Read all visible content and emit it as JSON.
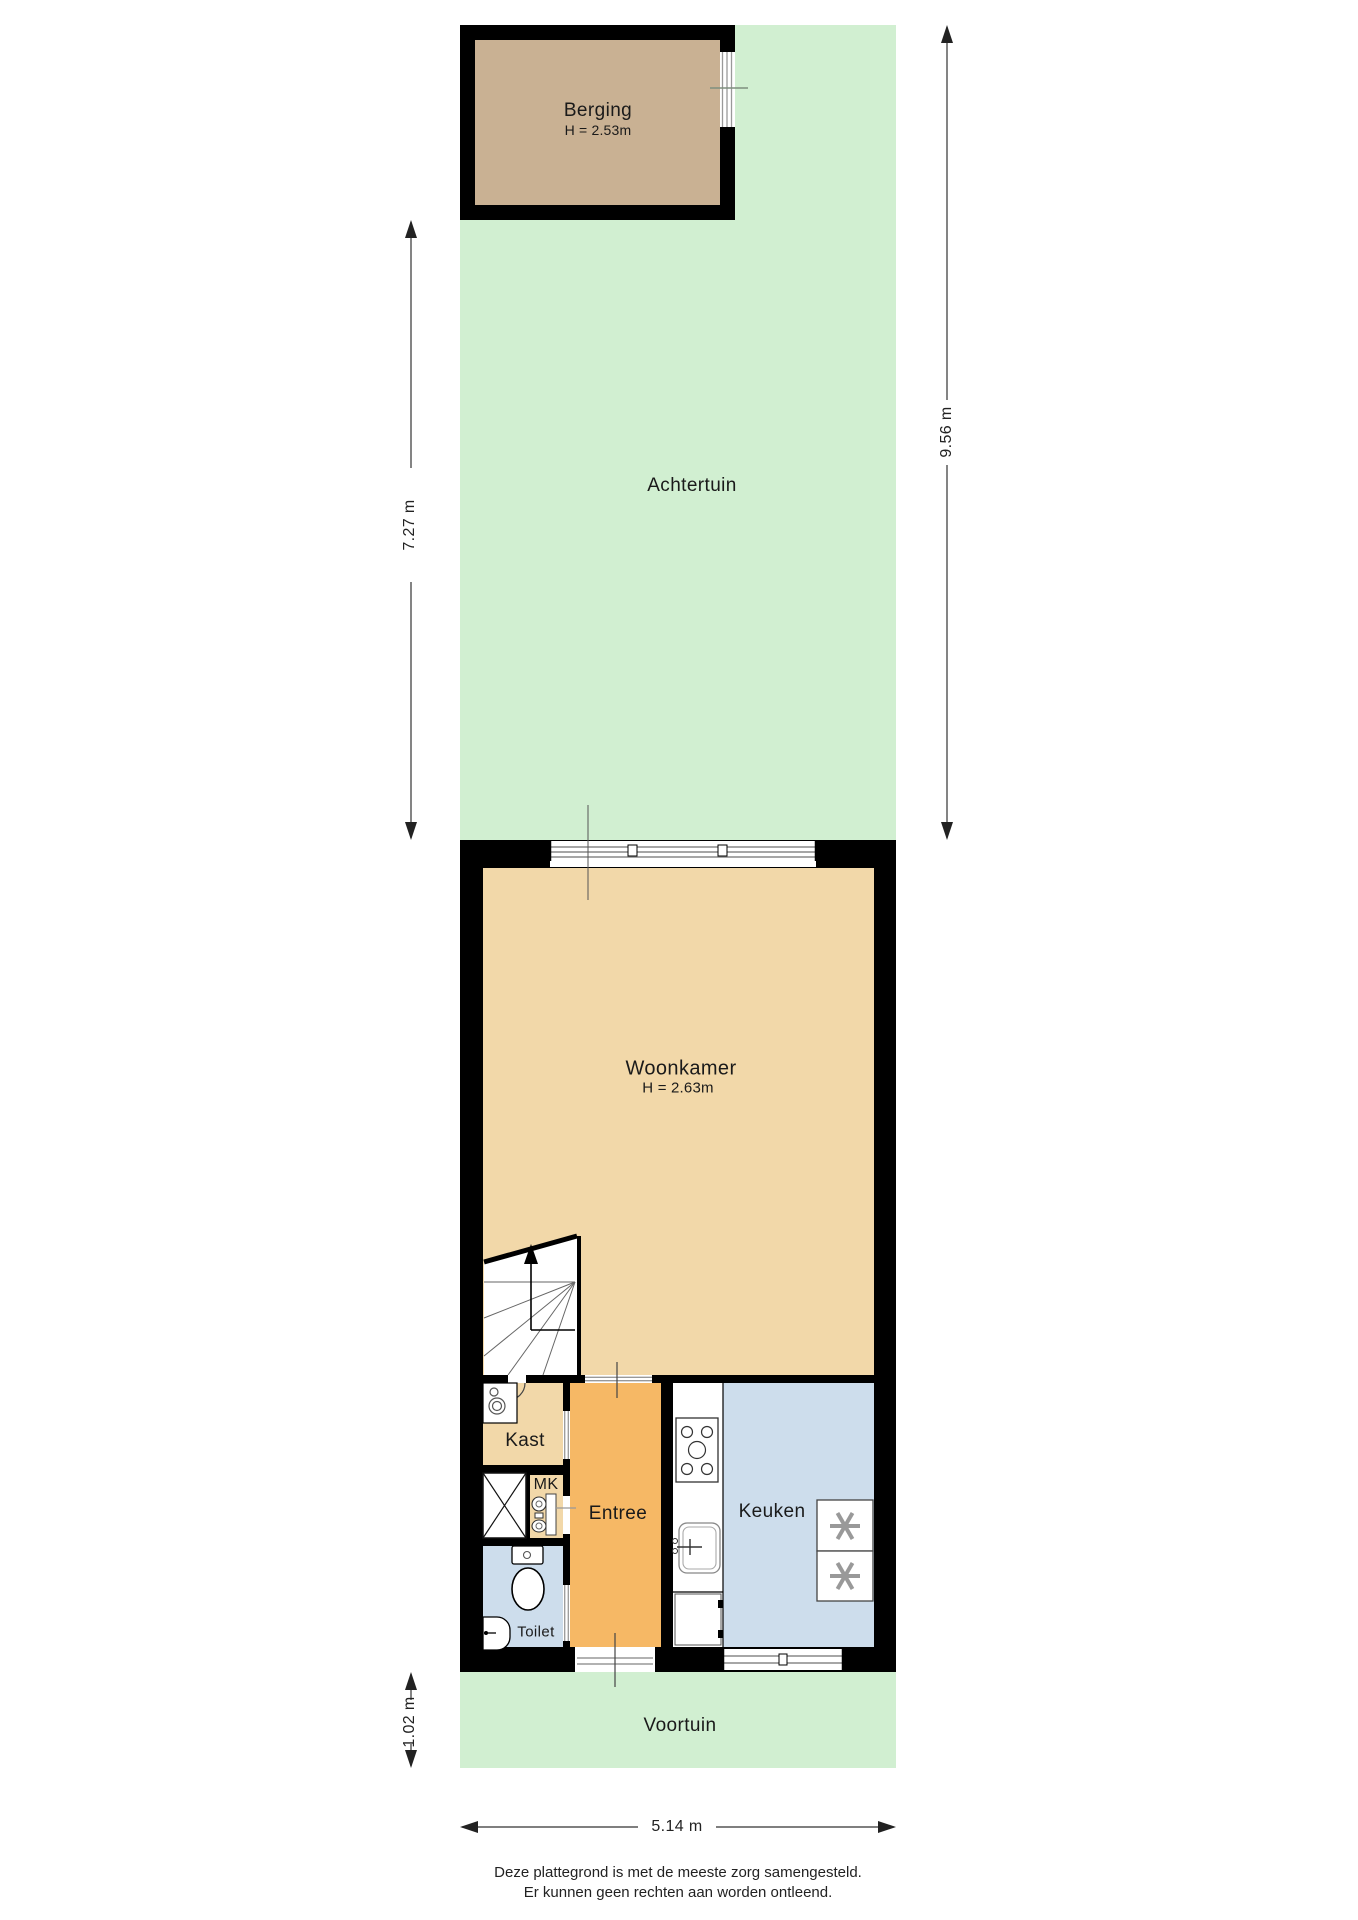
{
  "rooms": {
    "berging": {
      "label": "Berging",
      "height_label": "H = 2.53m"
    },
    "achtertuin": {
      "label": "Achtertuin"
    },
    "woonkamer": {
      "label": "Woonkamer",
      "height_label": "H = 2.63m"
    },
    "kast": {
      "label": "Kast"
    },
    "mk": {
      "label": "MK"
    },
    "entree": {
      "label": "Entree"
    },
    "keuken": {
      "label": "Keuken"
    },
    "toilet": {
      "label": "Toilet"
    },
    "voortuin": {
      "label": "Voortuin"
    }
  },
  "dimensions": {
    "back_garden_height": "7.27 m",
    "total_height": "9.56 m",
    "front_garden_height": "1.02 m",
    "plot_width": "5.14 m"
  },
  "footer": {
    "line1": "Deze plattegrond is met de meeste zorg samengesteld.",
    "line2": "Er kunnen geen rechten aan worden ontleend."
  },
  "colors": {
    "garden": "#d1efd1",
    "shed_floor": "#c9b193",
    "living_floor": "#f2d8a9",
    "entry_floor": "#f6b865",
    "wet_floor": "#cdddec",
    "wall": "#000000",
    "dimension": "#222222"
  }
}
